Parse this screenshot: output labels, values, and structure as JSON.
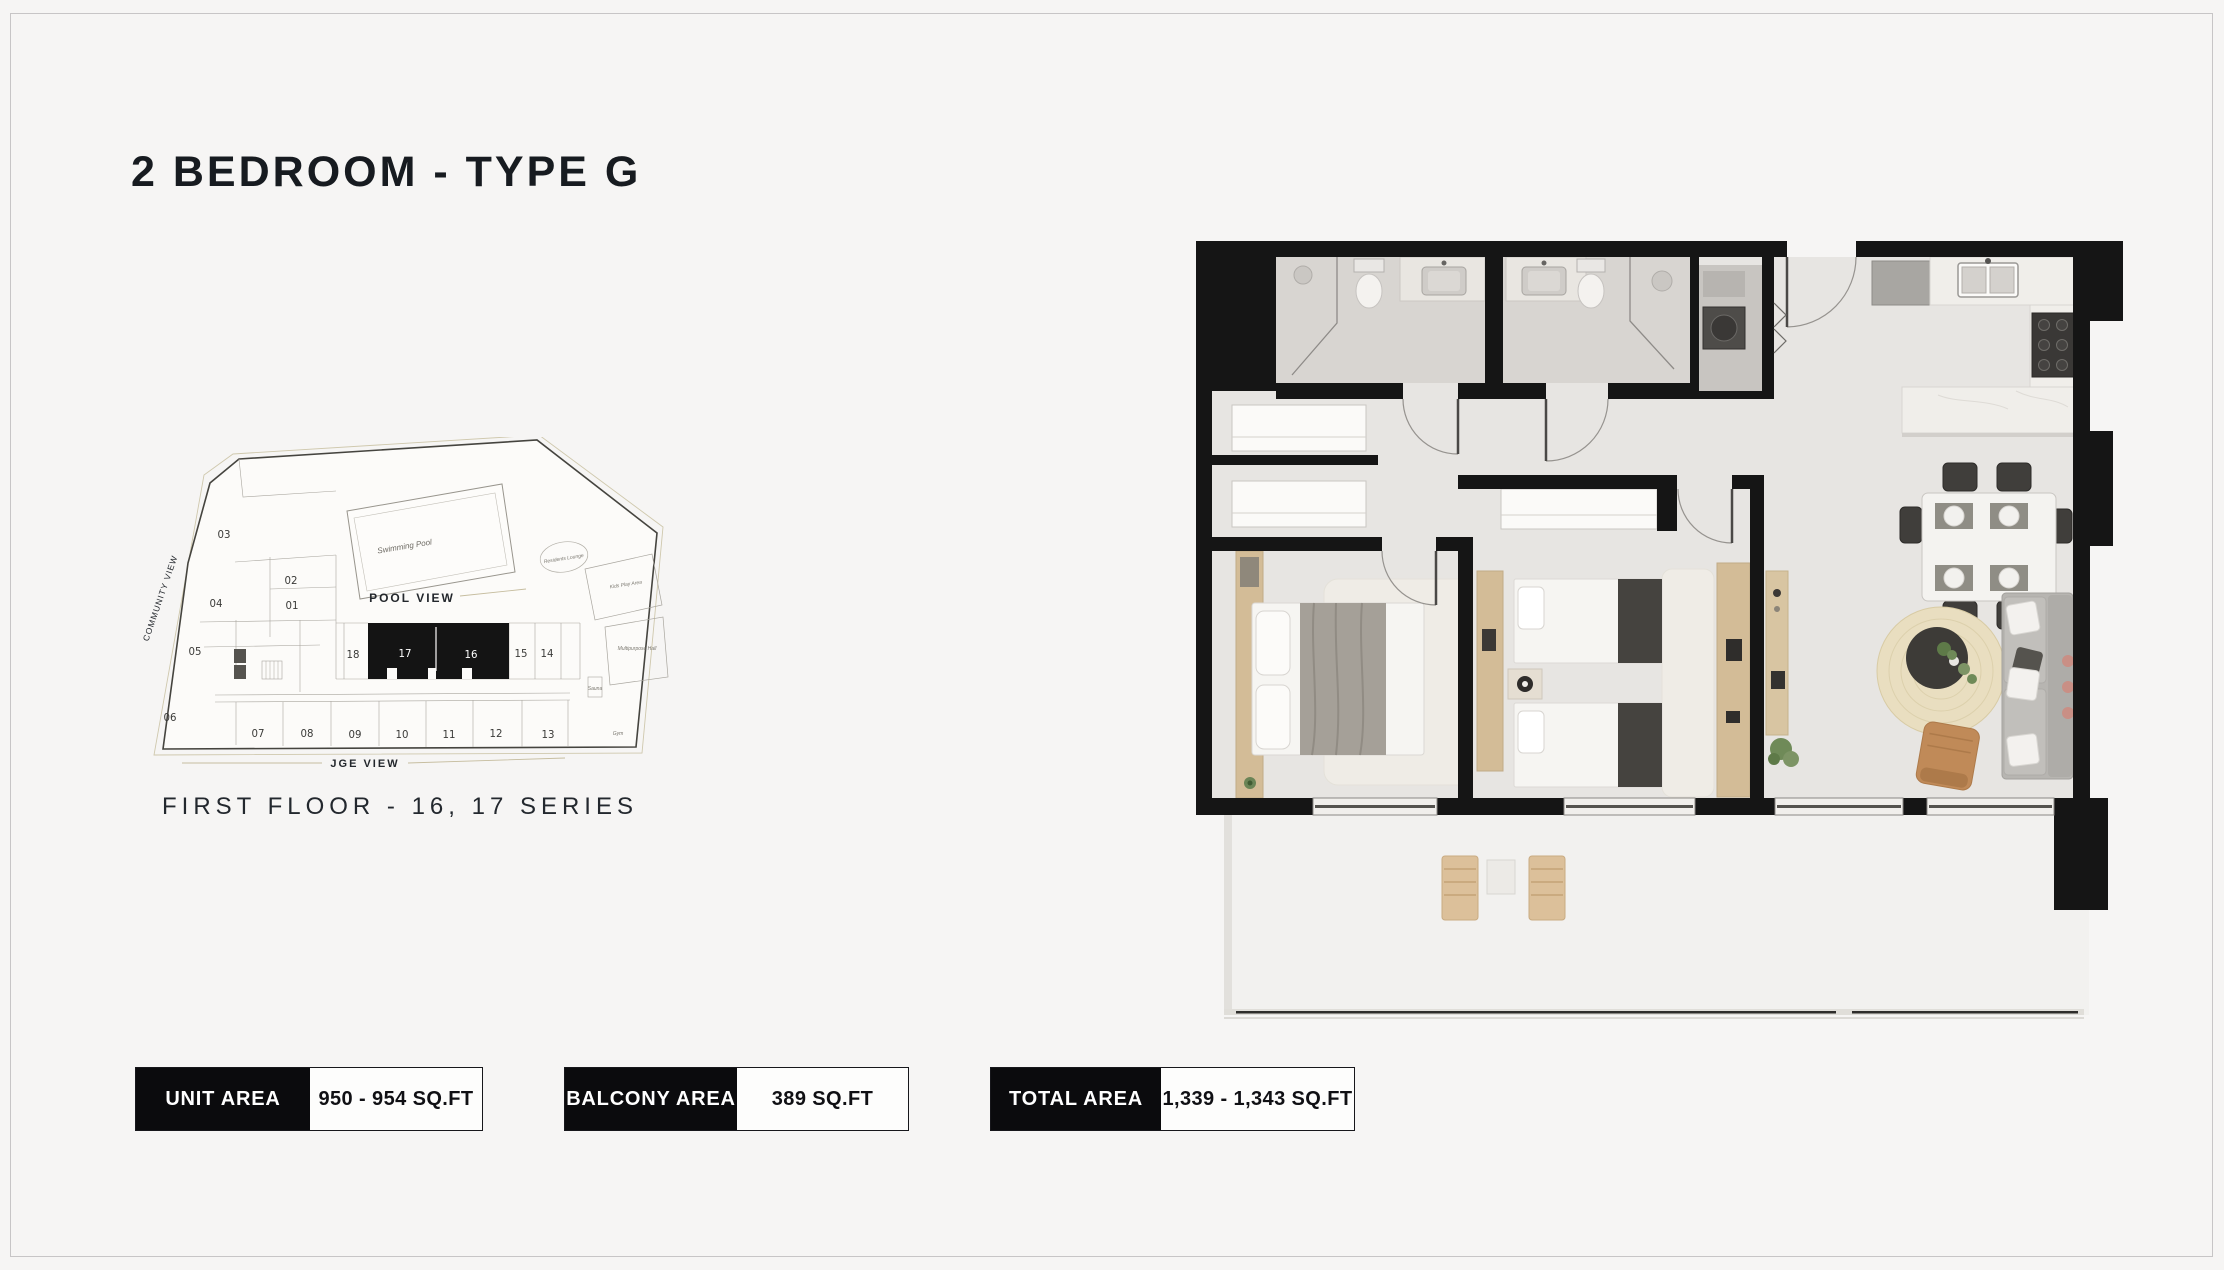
{
  "page": {
    "title": "2 BEDROOM - TYPE G"
  },
  "key_plan": {
    "caption": "FIRST FLOOR - 16, 17 SERIES",
    "labels": {
      "pool_view": "POOL VIEW",
      "community_view": "COMMUNITY VIEW",
      "jge_view": "JGE VIEW",
      "swimming_pool": "Swimming Pool",
      "residents_lounge": "Residents Lounge",
      "kids_play_area": "Kids Play Area",
      "multipurpose_hall": "Multipurpose Hall",
      "sauna": "Sauna",
      "gym": "Gym"
    },
    "units": [
      {
        "label": "01"
      },
      {
        "label": "02"
      },
      {
        "label": "03"
      },
      {
        "label": "04"
      },
      {
        "label": "05"
      },
      {
        "label": "06"
      },
      {
        "label": "07"
      },
      {
        "label": "08"
      },
      {
        "label": "09"
      },
      {
        "label": "10"
      },
      {
        "label": "11"
      },
      {
        "label": "12"
      },
      {
        "label": "13"
      },
      {
        "label": "14"
      },
      {
        "label": "15"
      },
      {
        "label": "16"
      },
      {
        "label": "17"
      },
      {
        "label": "18"
      }
    ],
    "highlighted_units": [
      "16",
      "17"
    ]
  },
  "area_summary": [
    {
      "label": "UNIT AREA",
      "value": "950 - 954 SQ.FT"
    },
    {
      "label": "BALCONY AREA",
      "value": "389 SQ.FT"
    },
    {
      "label": "TOTAL AREA",
      "value": "1,339 - 1,343 SQ.FT"
    }
  ],
  "colors": {
    "page_bg": "#f6f5f4",
    "wall_black": "#151515",
    "accent_black": "#0b0b0d",
    "floor": "#e7e5e2",
    "wood": "#d3bc97",
    "jute_rug": "#e9dec0"
  }
}
